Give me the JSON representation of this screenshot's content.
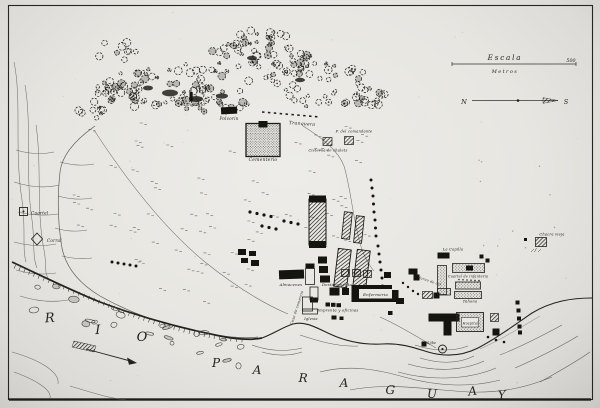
{
  "scale": {
    "label": "Escala",
    "unit": "Metros",
    "end_value": "500"
  },
  "compass": {
    "north": "N",
    "south": "S"
  },
  "river_name": "RIO PARAGUAY",
  "labels": {
    "mangrullo": "Mangrullo",
    "polvorin": "Polvorin",
    "tranquera": "Tranquera",
    "cementerio": "Cementerio",
    "chalet_top": "F. del comandante",
    "chalet_bottom": "Cisterna de chalets",
    "cuartel": "Cuartel",
    "corral": "Corral",
    "almacenes": "Almacenes",
    "destacamento": "Destacamento",
    "enfermeria": "Enfermeria",
    "casa_comercio": "Casa de comercio",
    "imprenta": "Imprenta y oficinas",
    "iglesia": "Iglesia",
    "la_capilla": "La Capilla",
    "cuartel_inf": "Cuartel de infanteria",
    "horno": "Horno de cal",
    "tahona": "Tahona",
    "hospital": "Hospital",
    "aljibe": "Aljibe",
    "chacra": "Chacra vieja"
  }
}
